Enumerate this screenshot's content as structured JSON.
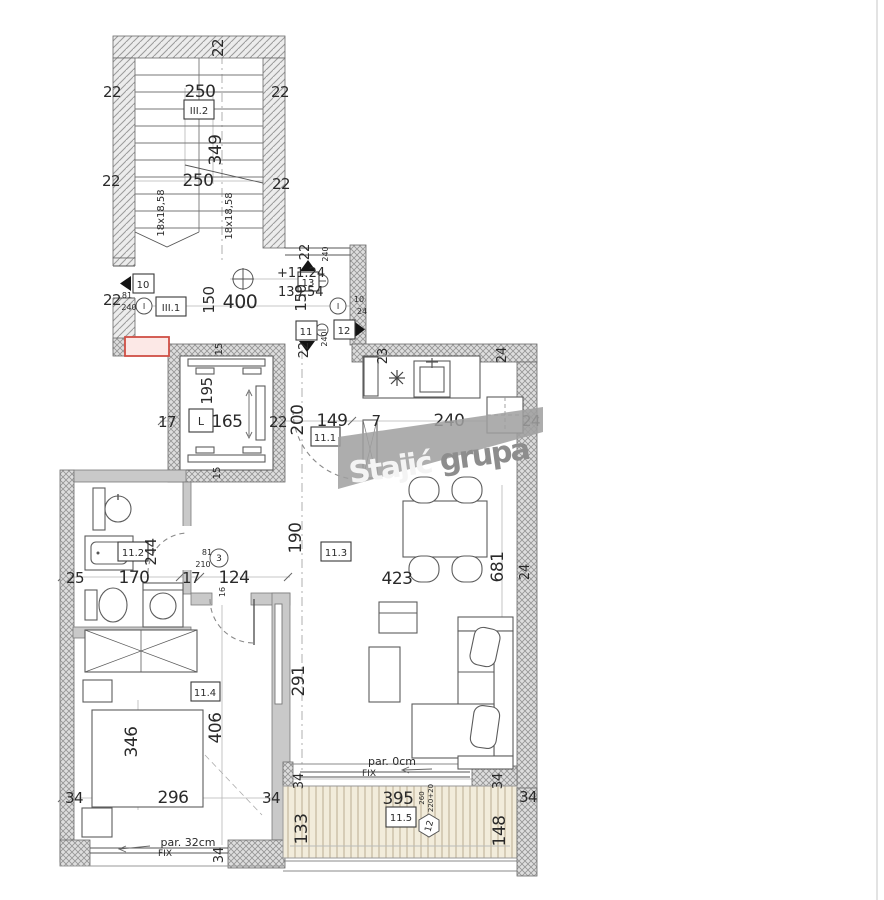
{
  "watermark": {
    "word1": "Stajić",
    "word2": "grupa"
  },
  "levels": {
    "upper": "+11.24",
    "lower": "139.54"
  },
  "units": {
    "stair_upper": "III.2",
    "stair_lower": "III.1",
    "elevator": "L",
    "hall": "11.1",
    "bath": "11.2",
    "living": "11.3",
    "bedroom": "11.4",
    "terrace": "11.5"
  },
  "doors": {
    "d10": "10",
    "d11": "11",
    "d12": "12",
    "d13": "13"
  },
  "axes": {
    "left": "I",
    "right": "I",
    "n3": "3",
    "n12": "12"
  },
  "dims": {
    "stairs": {
      "top_w": "22",
      "w1": "250",
      "w2": "250",
      "h": "349",
      "l1": "22",
      "r1": "22",
      "l2": "22",
      "r2": "22",
      "run1": "18x18,58",
      "run2": "18x18,58"
    },
    "hall_top": {
      "len": "400",
      "op_l": "150",
      "op_r": "150",
      "wall_l": "22",
      "small_w": "81",
      "small_h": "240",
      "ax_t22": "22",
      "ax_t240": "240",
      "ax_b22": "22",
      "ax_b240": "240",
      "small_r10": "10",
      "small_r24": "24"
    },
    "row_mid": {
      "e17": "17",
      "e165": "165",
      "e22": "22",
      "h200": "200",
      "h149": "149",
      "h7": "7",
      "k240": "240",
      "k24": "24"
    },
    "elevator": {
      "t15": "15",
      "h195": "195",
      "b15": "15"
    },
    "walls_top": {
      "k23": "23",
      "k24": "24"
    },
    "row_bath": {
      "b25": "25",
      "b170": "170",
      "b17": "17",
      "c124": "124",
      "l423": "423"
    },
    "vert": {
      "l190": "190",
      "l681": "681",
      "l291": "291",
      "b244": "244",
      "bd346": "346",
      "bd406": "406",
      "r24": "24"
    },
    "small_bath": {
      "w81": "81",
      "h210": "210",
      "d16": "16"
    },
    "row_bottom": {
      "m34a": "34",
      "b296": "296",
      "m34b": "34",
      "t395": "395",
      "m34c": "34"
    },
    "bedroom_win": {
      "par": "par. 32cm",
      "fix": "FIX",
      "w34": "34"
    },
    "living_win": {
      "par": "par. 0cm",
      "fix": "FIX"
    },
    "terrace": {
      "v133": "133",
      "v148": "148",
      "t34l": "34",
      "t34r": "34",
      "g260": "260",
      "g220": "220+20"
    }
  }
}
